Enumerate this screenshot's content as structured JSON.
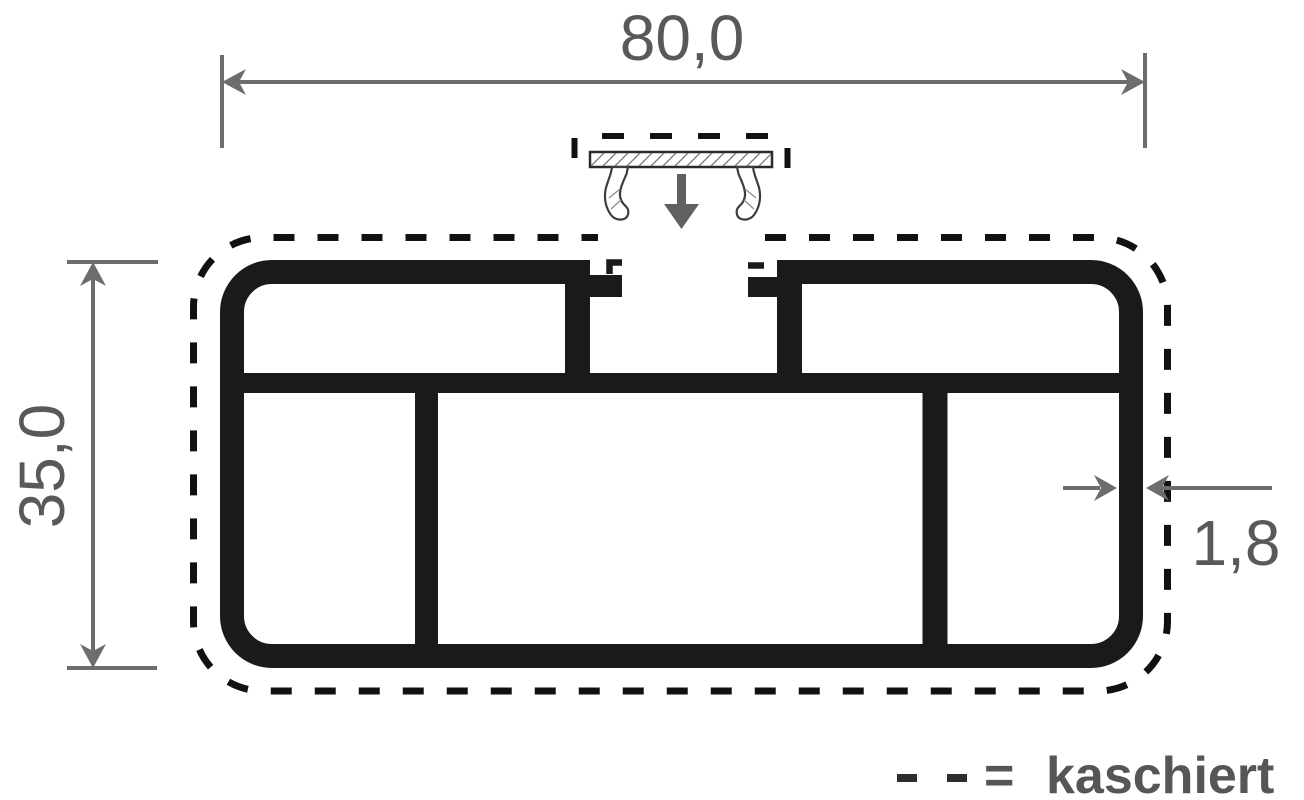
{
  "dimensions": {
    "width_label": "80,0",
    "height_label": "35,0",
    "wall_thickness_label": "1,8"
  },
  "legend": {
    "dash_symbol": "- -",
    "equals_sign": "=",
    "label": "kaschiert"
  },
  "icons": {
    "insert_arrow": "arrow-down"
  },
  "colors": {
    "background": "#ffffff",
    "profile": "#1a1a1a",
    "kaschiert_outline": "#111111",
    "dimension_lines": "#6d6d6d",
    "dimension_text": "#595959",
    "legend_text": "#565656",
    "legend_dashes": "#2d2d2d",
    "clip_arrow": "#606060"
  }
}
